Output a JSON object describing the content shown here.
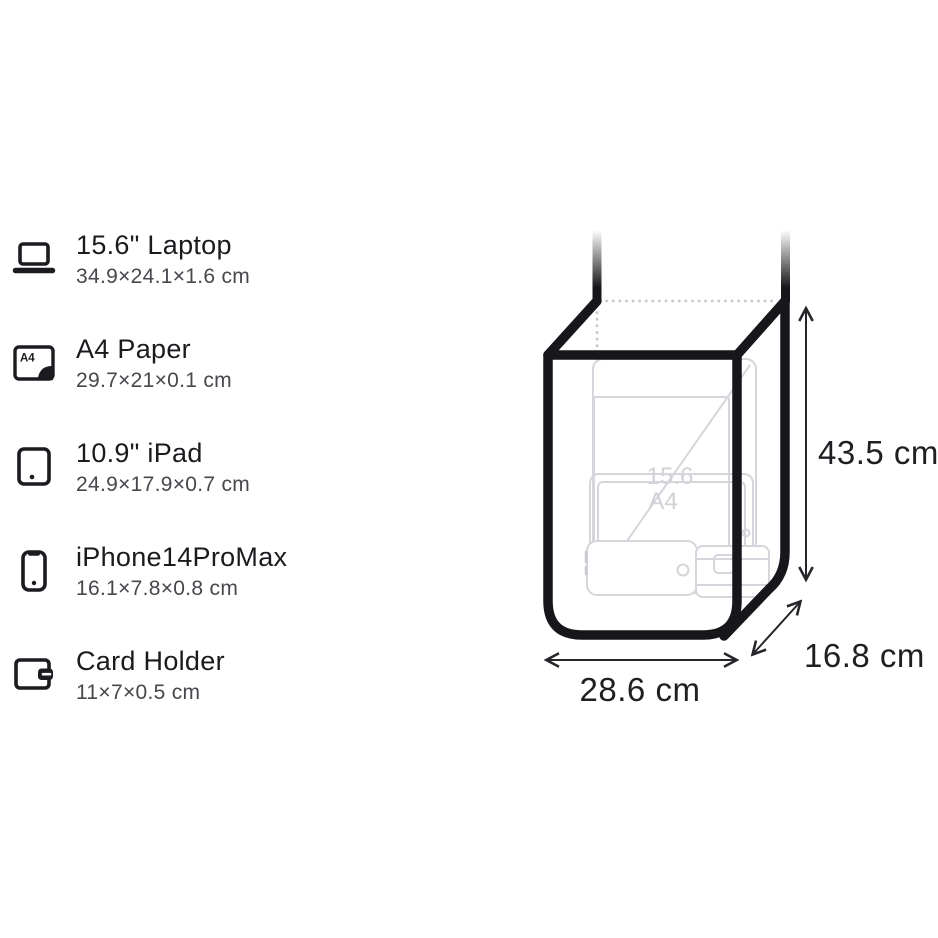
{
  "comparison_list": {
    "a4_icon_text": "A4",
    "items": [
      {
        "icon": "laptop-icon",
        "title": "15.6\" Laptop",
        "dimensions": "34.9×24.1×1.6 cm"
      },
      {
        "icon": "a4-paper-icon",
        "title": "A4 Paper",
        "dimensions": "29.7×21×0.1 cm"
      },
      {
        "icon": "ipad-icon",
        "title": "10.9\" iPad",
        "dimensions": "24.9×17.9×0.7 cm"
      },
      {
        "icon": "iphone-icon",
        "title": "iPhone14ProMax",
        "dimensions": "16.1×7.8×0.8 cm"
      },
      {
        "icon": "card-holder-icon",
        "title": "Card Holder",
        "dimensions": "11×7×0.5 cm"
      }
    ]
  },
  "bag_diagram": {
    "height_label": "43.5 cm",
    "width_label": "28.6 cm",
    "depth_label": "16.8 cm",
    "ghost_labels": {
      "laptop_diagonal": "15.6",
      "paper": "A4"
    },
    "colors": {
      "bag_outline": "#17171b",
      "ghost_items": "#d5d5db",
      "dotted_hidden_edges": "#c7c7cd",
      "dimension_text": "#1f1f23"
    }
  }
}
